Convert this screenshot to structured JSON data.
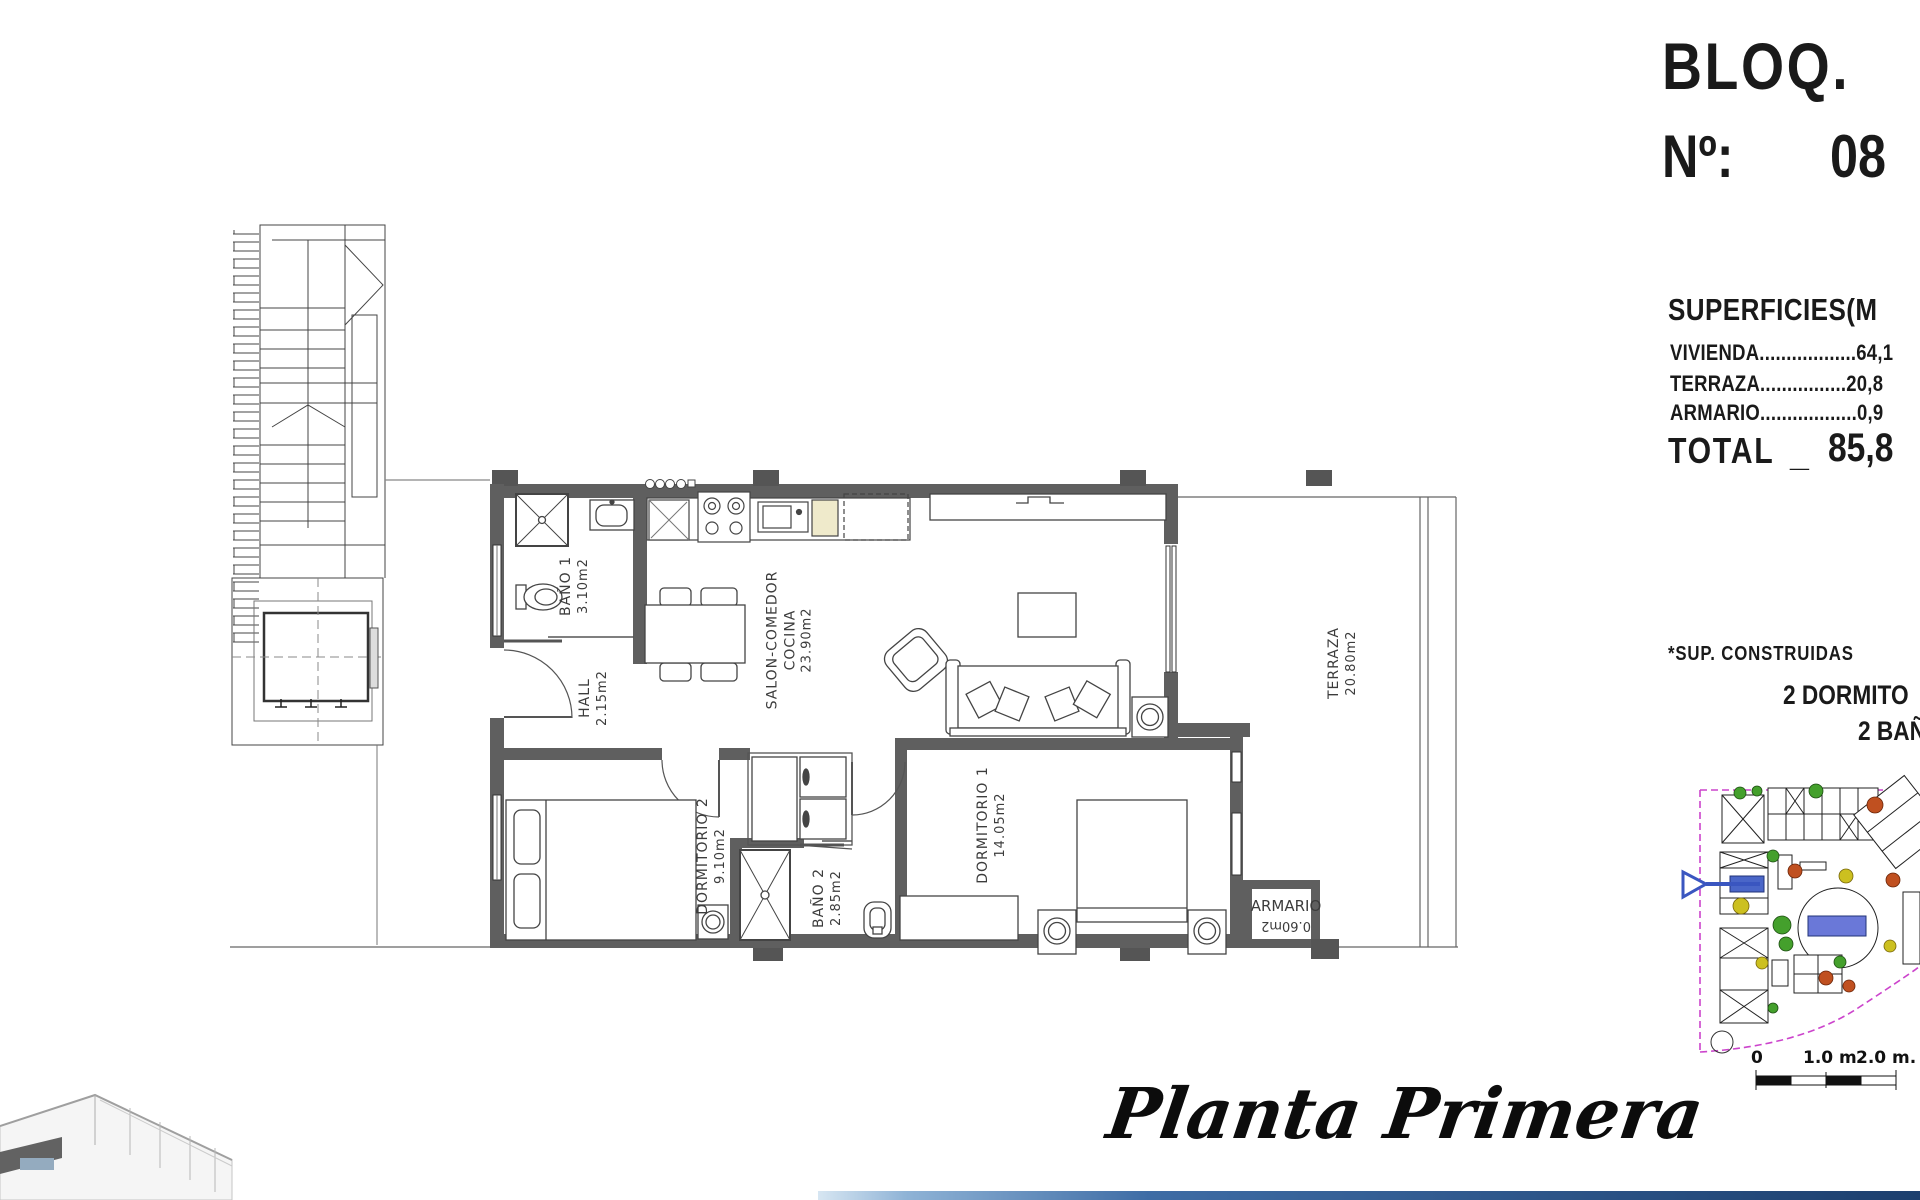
{
  "title_block": {
    "bloq_label": "BLOQ.",
    "num_label": "Nº:",
    "num_value": "08"
  },
  "superficies": {
    "heading": "SUPERFICIES(M",
    "rows": [
      {
        "label": "VIVIENDA",
        "leader": "..................",
        "value": "64,1"
      },
      {
        "label": "TERRAZA",
        "leader": "................",
        "value": "20,8"
      },
      {
        "label": "ARMARIO",
        "leader": "..................",
        "value": "0,9"
      }
    ],
    "total_label": "TOTAL",
    "total_sep": "_",
    "total_value": "85,8"
  },
  "notes": {
    "sup_construidas": "*SUP. CONSTRUIDAS",
    "dormitorios": "2 DORMITO",
    "banos": "2 BAÑ"
  },
  "plan": {
    "rooms": [
      {
        "name": "BAÑO 1",
        "area": "3.10m2"
      },
      {
        "name": "HALL",
        "area": "2.15m2"
      },
      {
        "name": "SALON-COMEDOR",
        "name2": "COCINA",
        "area": "23.90m2"
      },
      {
        "name": "DORMITORIO 2",
        "area": "9.10m2"
      },
      {
        "name": "BAÑO 2",
        "area": "2.85m2"
      },
      {
        "name": "DORMITORIO 1",
        "area": "14.05m2"
      },
      {
        "name": "TERRAZA",
        "area": "20.80m2"
      },
      {
        "name": "ARMARIO",
        "area": "0.60m2"
      }
    ]
  },
  "scale_bar": {
    "labels": [
      "0",
      "1.0 m.",
      "2.0 m."
    ]
  },
  "footer": {
    "plan_name": "Planta Primera"
  },
  "colors": {
    "wall_gray": "#5f5f5f",
    "bar_blue": "#1c3f6e",
    "site_boundary_magenta": "#cc44cc",
    "site_unit_blue": "#4a66c8",
    "tree_green": "#44a02c",
    "tree_orange": "#c05020",
    "tree_yellow": "#ccc020",
    "counter_cream": "#efeacb"
  }
}
